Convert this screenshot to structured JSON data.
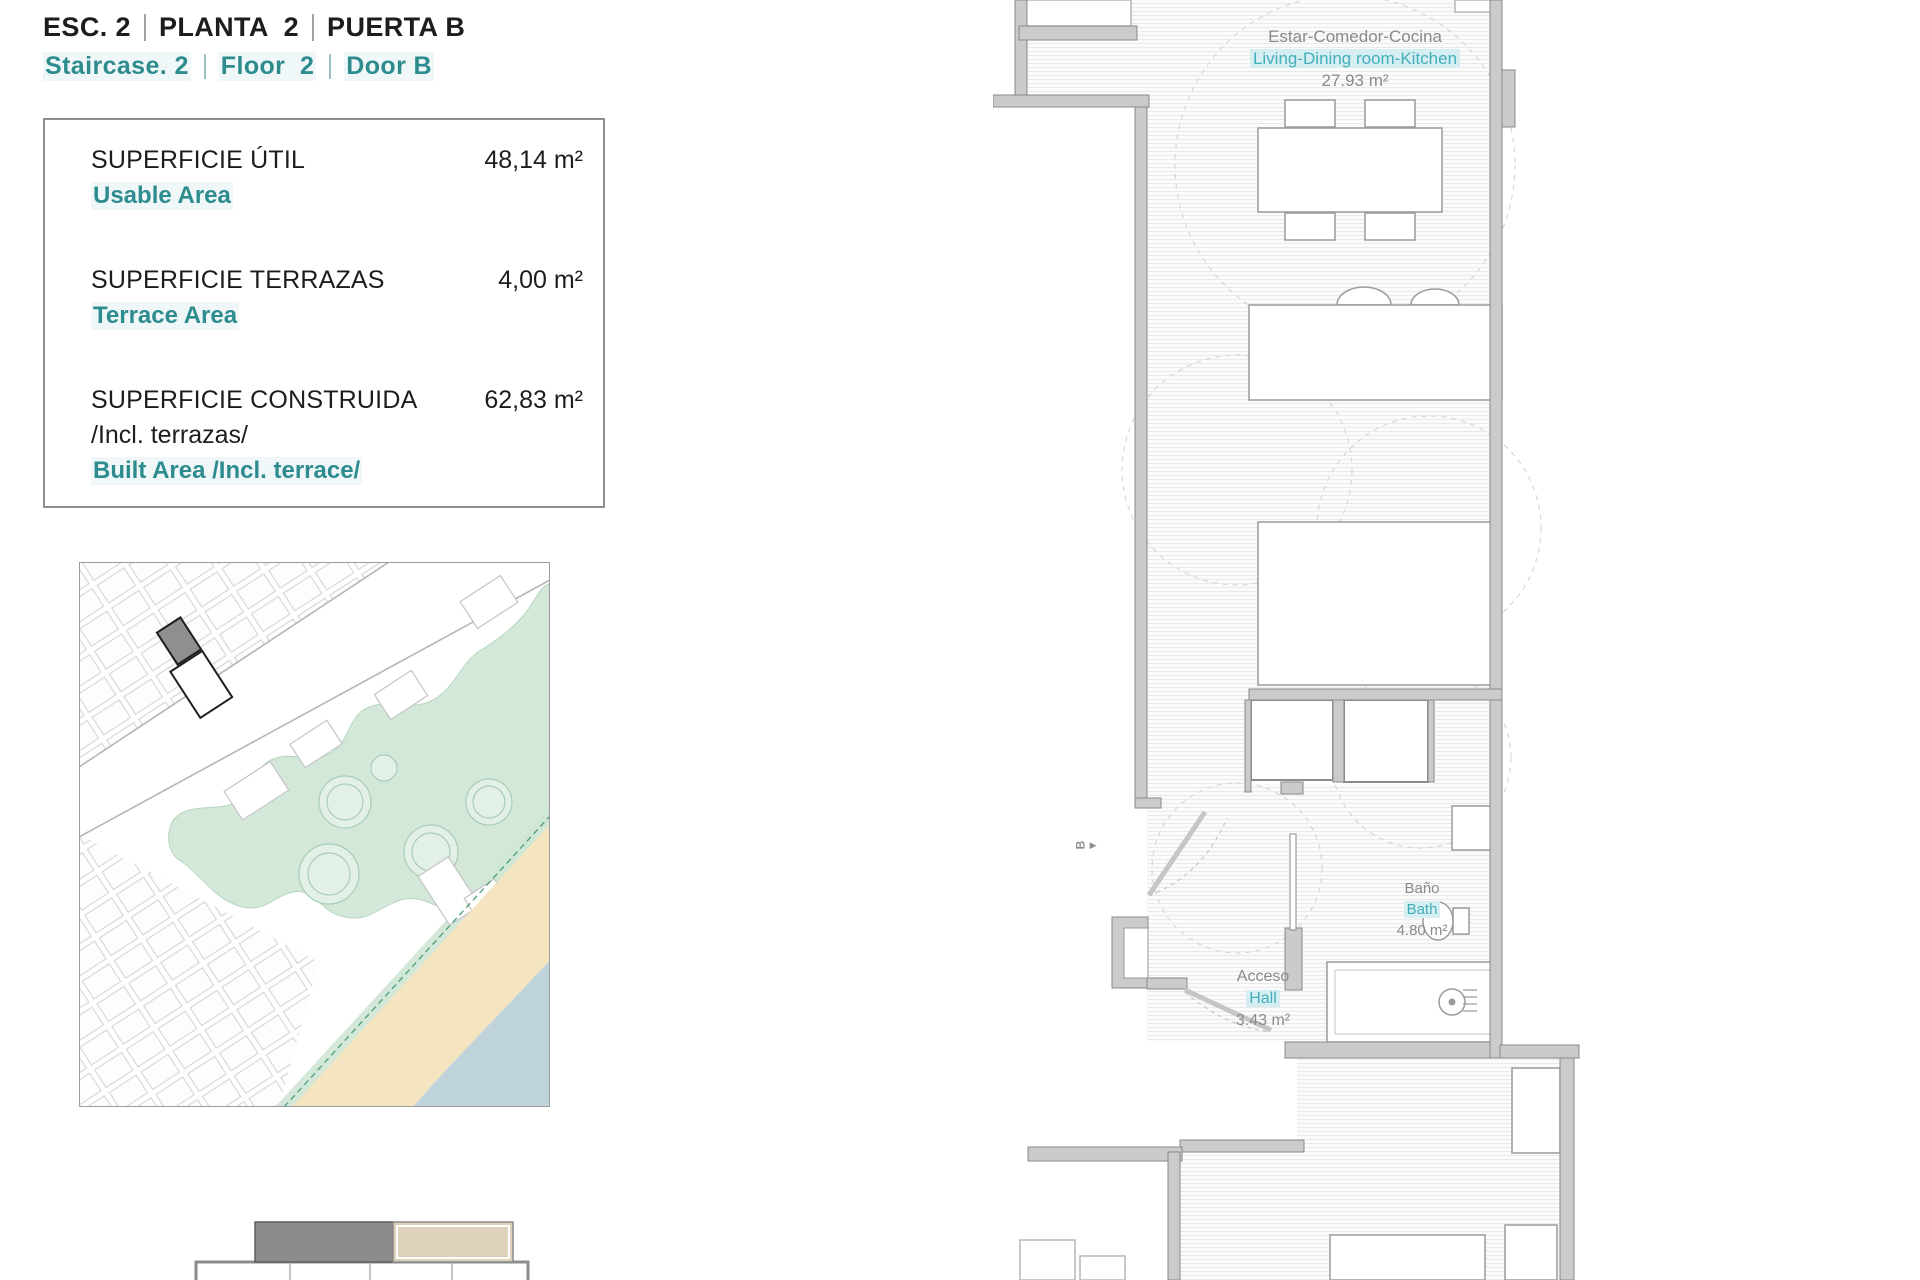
{
  "header": {
    "title_es": {
      "p1": "ESC. 2",
      "p2": "PLANTA  2",
      "p3": "PUERTA B"
    },
    "title_en": {
      "p1": "Staircase. 2",
      "p2": "Floor  2",
      "p3": "Door B"
    }
  },
  "area_summary": {
    "rows": [
      {
        "label_es": "SUPERFICIE ÚTIL",
        "label_en": "Usable Area",
        "value": "48,14 m²"
      },
      {
        "label_es": "SUPERFICIE TERRAZAS",
        "label_en": "Terrace Area",
        "value": "4,00 m²"
      },
      {
        "label_es": "SUPERFICIE CONSTRUIDA",
        "label_es_line2": "/Incl. terrazas/",
        "label_en": "Built Area /Incl. terrace/",
        "value": "62,83 m²"
      }
    ]
  },
  "floor_plan": {
    "rooms": [
      {
        "name_es": "Estar-Comedor-Cocina",
        "name_en": "Living-Dining room-Kitchen",
        "area": "27.93 m²"
      },
      {
        "name_es": "Baño",
        "name_en": "Bath",
        "area": "4.80 m²"
      },
      {
        "name_es": "Acceso",
        "name_en": "Hall",
        "area": "3.43 m²"
      }
    ],
    "section_marker": "B"
  },
  "colors": {
    "heading_teal": "#2e8c8f",
    "room_label_teal": "#45aebb",
    "park_green": "#cfe6d6",
    "beach_sand": "#f4e4c0",
    "sea_water": "#bfd3da",
    "wall_gray": "#cbcbcb",
    "highlighted_building_gray": "#8f8f8f",
    "section_block_dark": "#8d8c8a",
    "section_block_beige": "#ddd1ba"
  }
}
